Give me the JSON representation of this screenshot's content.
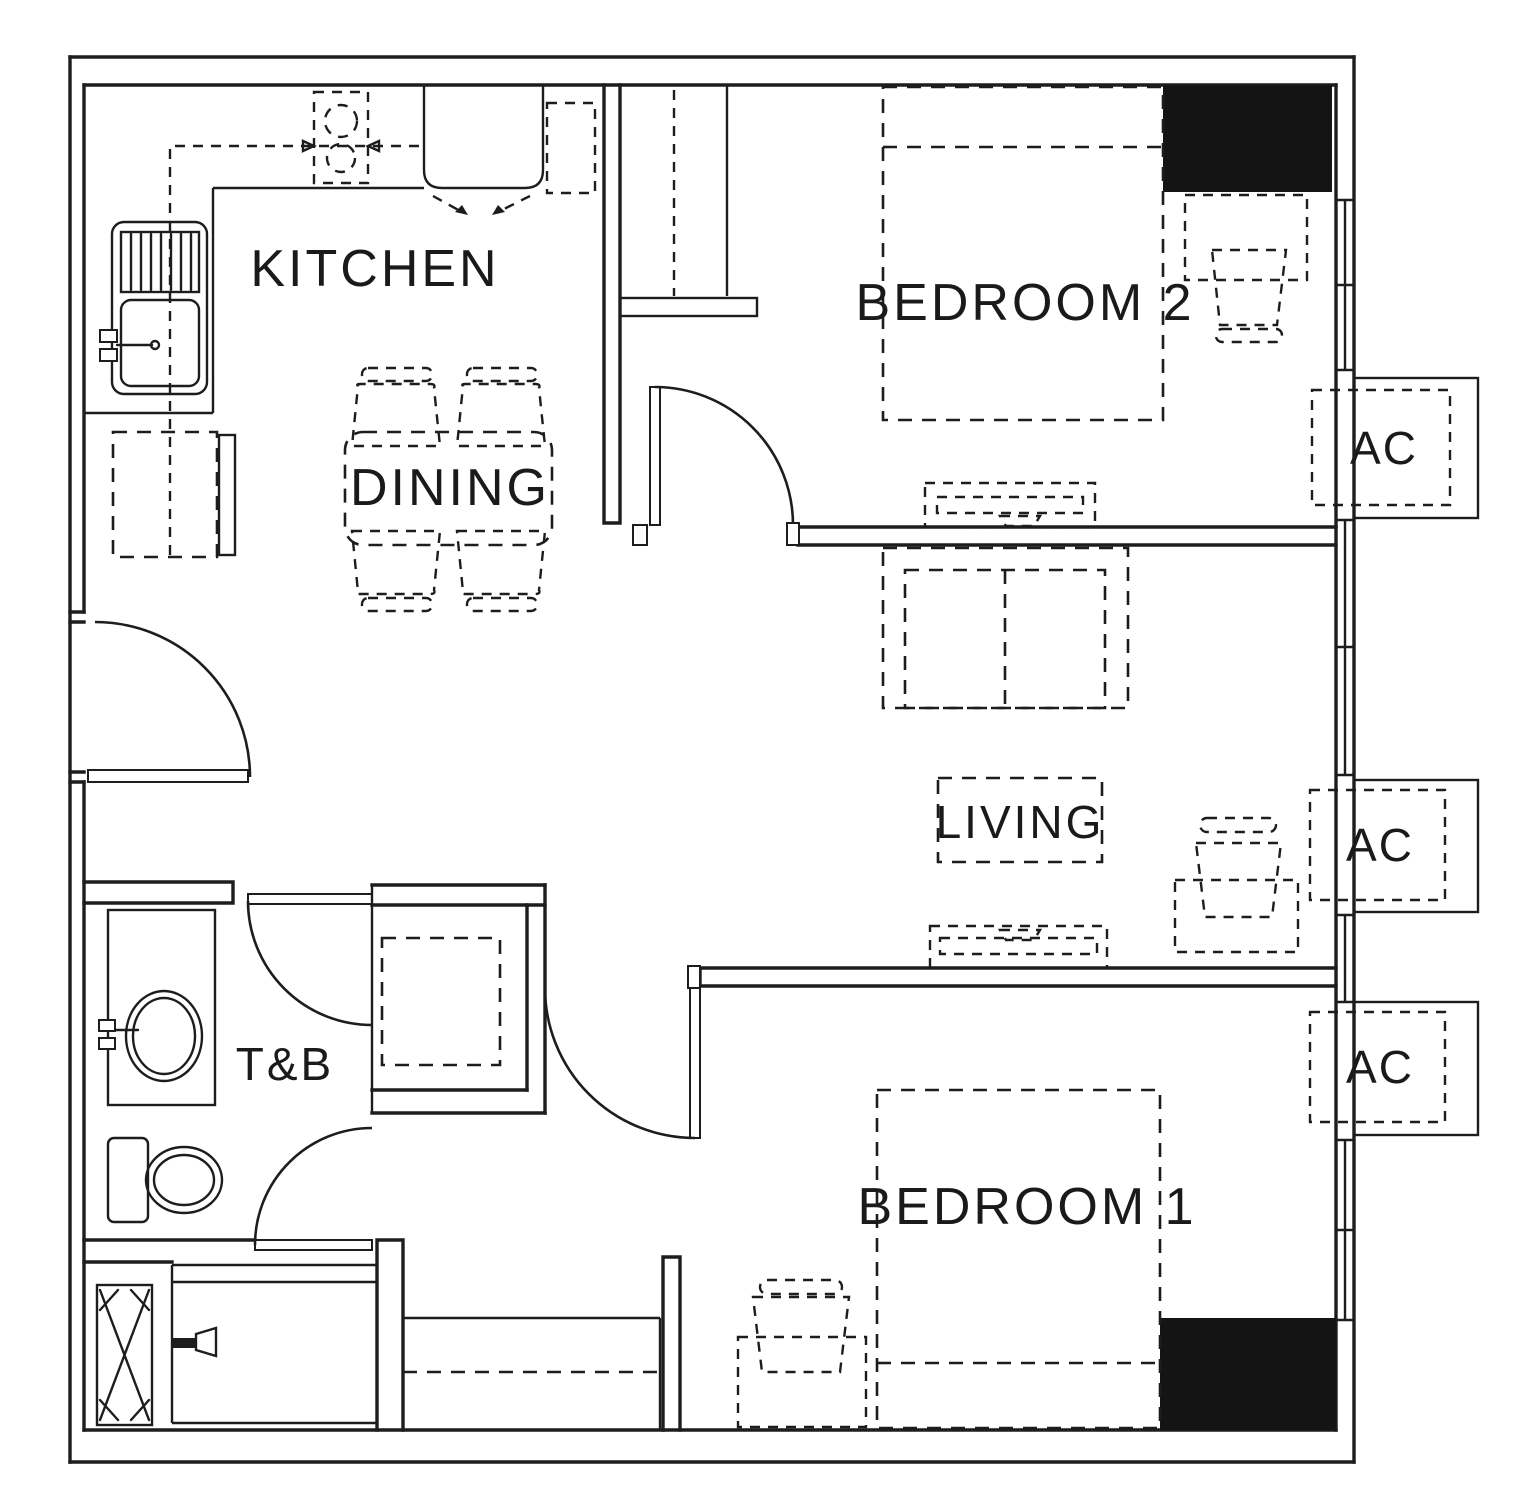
{
  "drawing": {
    "type": "floor-plan",
    "unit": "2-bedroom residential unit",
    "background": "#ffffff",
    "line_color": "#1d1d1d",
    "column_fill": "#141414"
  },
  "rooms": {
    "kitchen": {
      "label": "KITCHEN"
    },
    "dining": {
      "label": "DINING"
    },
    "living": {
      "label": "LIVING"
    },
    "toilet_bath": {
      "label": "T&B"
    },
    "bedroom1": {
      "label": "BEDROOM 1"
    },
    "bedroom2": {
      "label": "BEDROOM 2"
    }
  },
  "ac_units": [
    {
      "label": "AC"
    },
    {
      "label": "AC"
    },
    {
      "label": "AC"
    }
  ]
}
